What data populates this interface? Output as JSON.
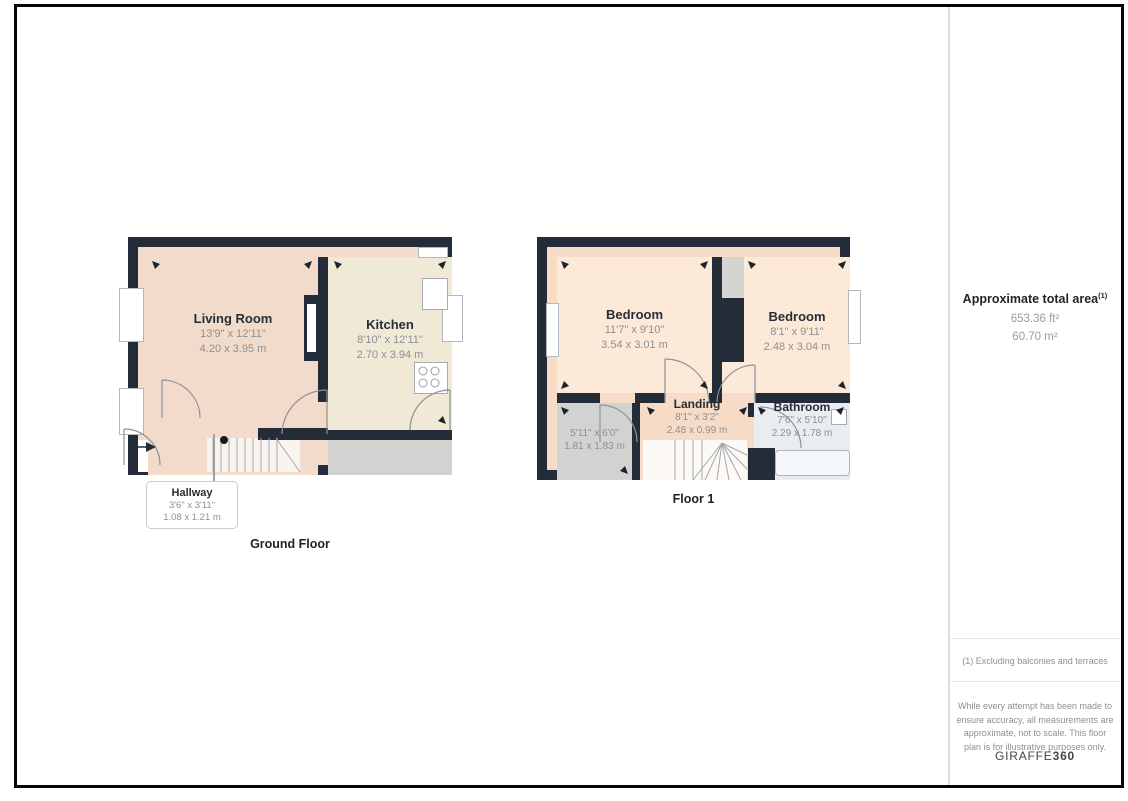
{
  "floor_plans": [
    {
      "label": "Ground Floor",
      "rooms": [
        {
          "name": "Living Room",
          "dims_imperial": "13'9\" x 12'11\"",
          "dims_metric": "4.20 x 3.95 m"
        },
        {
          "name": "Kitchen",
          "dims_imperial": "8'10\" x 12'11\"",
          "dims_metric": "2.70 x 3.94 m"
        },
        {
          "name": "Hallway",
          "dims_imperial": "3'6\" x 3'11\"",
          "dims_metric": "1.08 x 1.21 m"
        }
      ]
    },
    {
      "label": "Floor 1",
      "rooms": [
        {
          "name": "Bedroom",
          "dims_imperial": "11'7\" x 9'10\"",
          "dims_metric": "3.54 x 3.01 m"
        },
        {
          "name": "Bedroom",
          "dims_imperial": "8'1\" x 9'11\"",
          "dims_metric": "2.48 x 3.04 m"
        },
        {
          "name": "Landing",
          "dims_imperial": "8'1\" x 3'2\"",
          "dims_metric": "2.48 x 0.99 m"
        },
        {
          "name": "Bathroom",
          "dims_imperial": "7'6\" x 5'10\"",
          "dims_metric": "2.29 x 1.78 m"
        },
        {
          "name": "",
          "dims_imperial": "5'11\" x 6'0\"",
          "dims_metric": "1.81 x 1.83 m"
        }
      ]
    }
  ],
  "sidebar": {
    "total_area_title": "Approximate total area",
    "total_area_sup": "(1)",
    "total_area_ft": "653.36 ft²",
    "total_area_m": "60.70 m²",
    "footnote": "(1) Excluding balconies and terraces",
    "disclaimer": "While every attempt has been made to ensure accuracy, all measurements are approximate, not to scale. This floor plan is for illustrative purposes only.",
    "brand_name": "GIRAFFE",
    "brand_suffix": "360"
  },
  "colors": {
    "wall": "#232c38",
    "living_room_fill": "#f2dbca",
    "kitchen_fill": "#efe9d6",
    "bedroom_fill": "#fce9d8",
    "landing_fill": "#f6dcc7",
    "bathroom_fill": "#e9edf1",
    "store_fill": "#d2d2d0",
    "stairs_fill": "#fbf4ee",
    "dims_text": "#8b9196",
    "name_text": "#262e36"
  }
}
